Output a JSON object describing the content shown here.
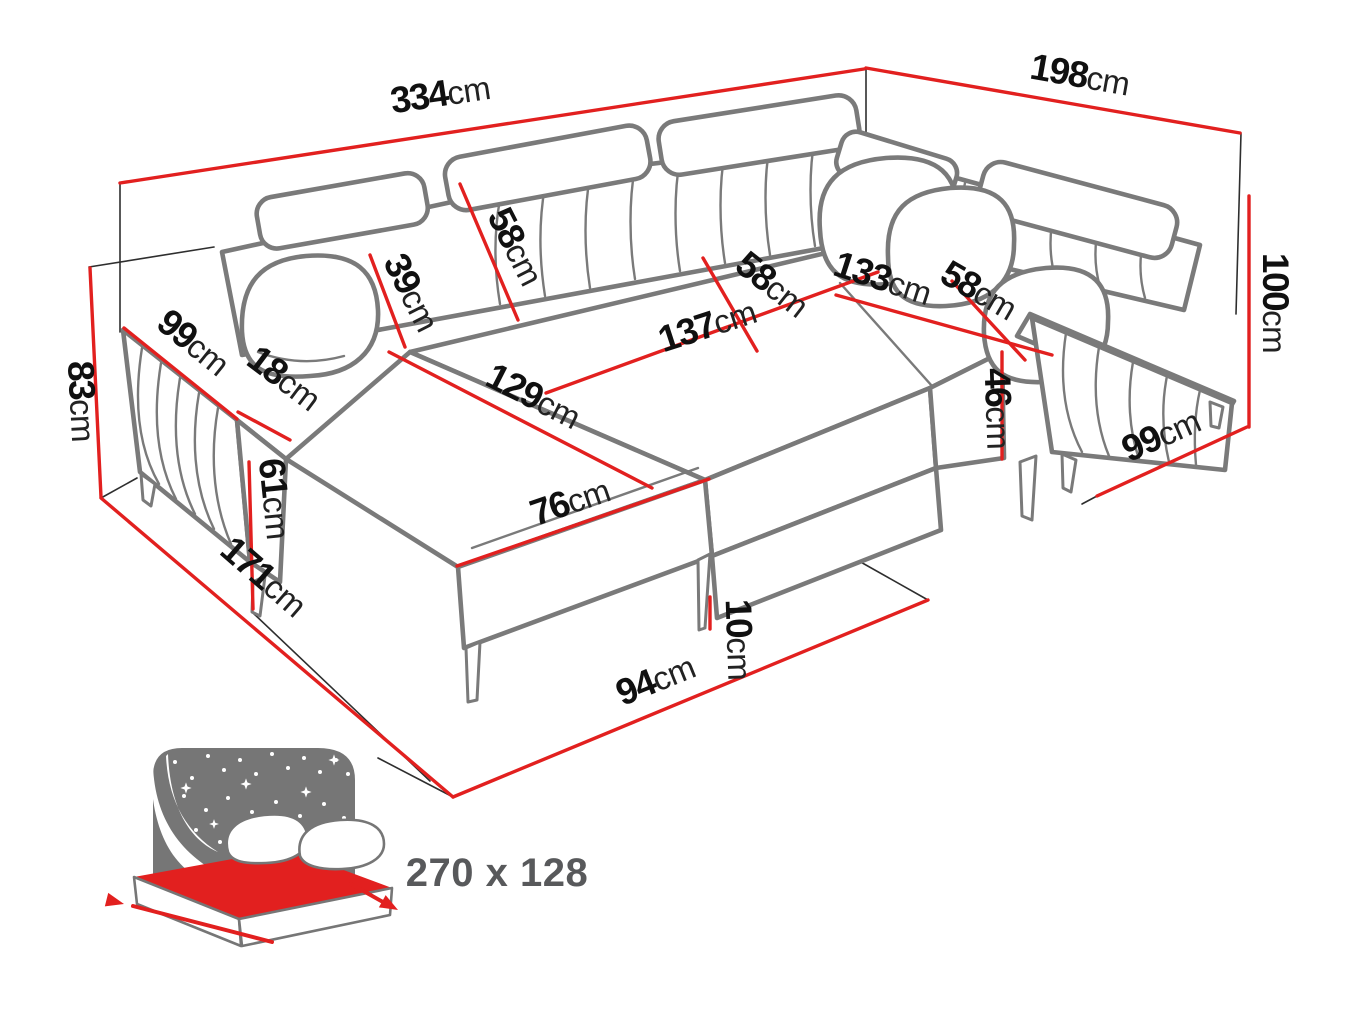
{
  "diagram": {
    "type": "furniture-dimension-diagram",
    "subject": "U-shaped corner sofa bed with measurement lines",
    "unit": "cm",
    "colors": {
      "dimension_line": "#e2201f",
      "sofa_outline": "#7a7a7a",
      "guide_line": "#2e2e2e",
      "label_number": "#101010",
      "label_unit": "#222222",
      "sleeping_text": "#58595b",
      "icon_gray": "#767676"
    },
    "dimensions": {
      "back_width": {
        "value": "334",
        "unit": "cm"
      },
      "right_side_depth": {
        "value": "198",
        "unit": "cm"
      },
      "right_height": {
        "value": "100",
        "unit": "cm"
      },
      "left_height": {
        "value": "83",
        "unit": "cm"
      },
      "left_armrest_length": {
        "value": "99",
        "unit": "cm"
      },
      "armrest_width": {
        "value": "18",
        "unit": "cm"
      },
      "armrest_height": {
        "value": "61",
        "unit": "cm"
      },
      "left_side_depth": {
        "value": "171",
        "unit": "cm"
      },
      "backrest_depth": {
        "value": "39",
        "unit": "cm"
      },
      "headrest_width": {
        "value": "58",
        "unit": "cm"
      },
      "chaise_length": {
        "value": "129",
        "unit": "cm"
      },
      "chaise_width": {
        "value": "76",
        "unit": "cm"
      },
      "middle_seat_width": {
        "value": "137",
        "unit": "cm"
      },
      "middle_seat_depth": {
        "value": "58",
        "unit": "cm"
      },
      "right_seat_width": {
        "value": "133",
        "unit": "cm"
      },
      "right_seat_depth": {
        "value": "58",
        "unit": "cm"
      },
      "seat_height": {
        "value": "46",
        "unit": "cm"
      },
      "right_armrest_length": {
        "value": "99",
        "unit": "cm"
      },
      "leg_height": {
        "value": "10",
        "unit": "cm"
      },
      "front_edge": {
        "value": "94",
        "unit": "cm"
      }
    },
    "sleeping_area": {
      "label": "270 x 128"
    }
  }
}
